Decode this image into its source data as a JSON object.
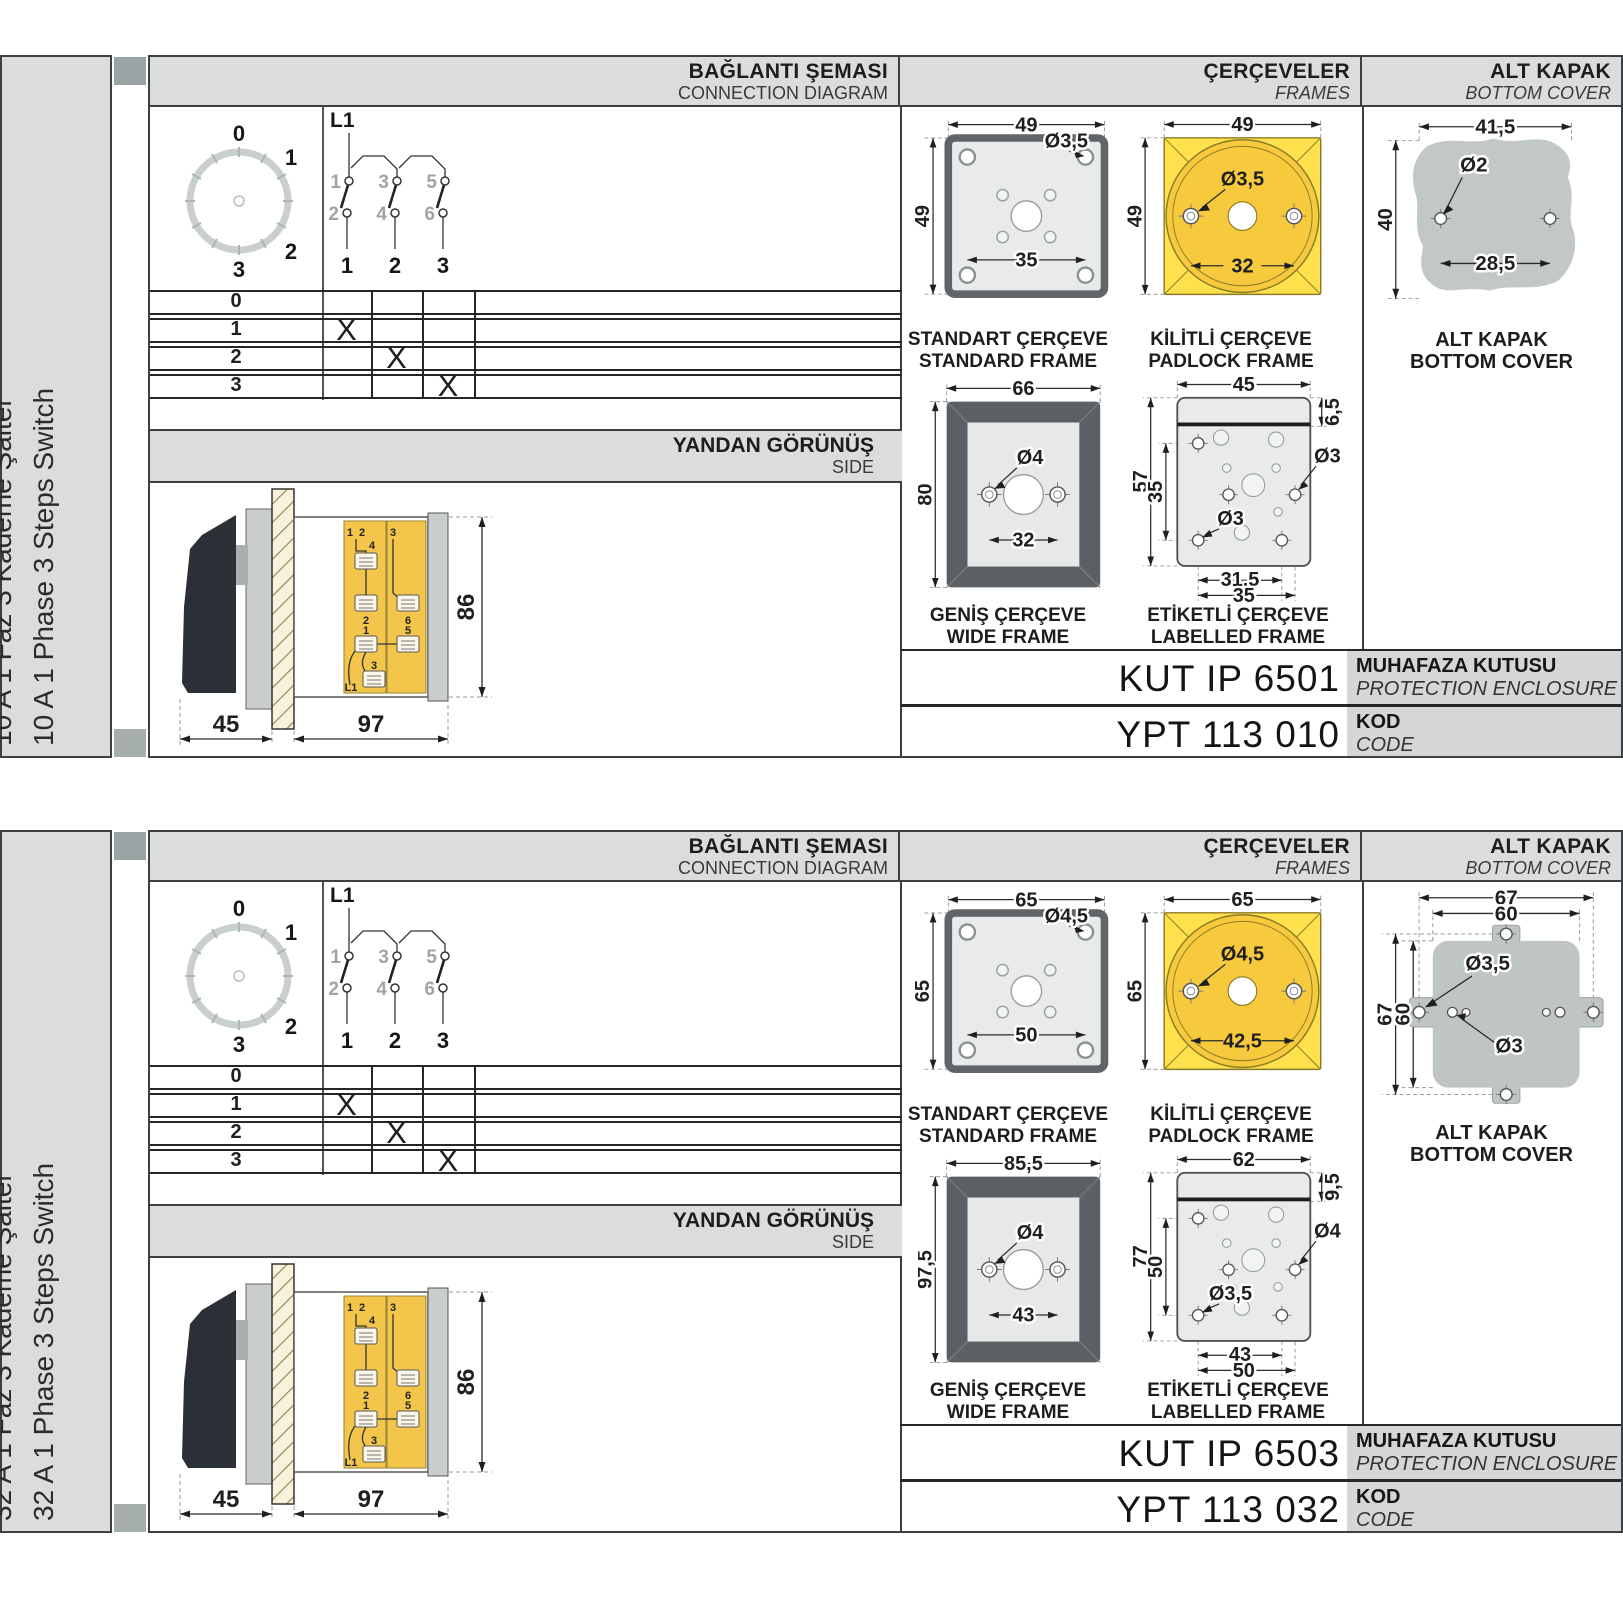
{
  "colors": {
    "accent_yellow": "#FFE14D",
    "golden": "#F7CA3E",
    "frame_dark": "#5B6065",
    "panel_gray": "#DBDCDC",
    "cover_gray": "#C2C7C7",
    "switch_body_yellow": "#F3C64B"
  },
  "sections": [
    {
      "sidebar": {
        "tr": "10 A 1 Faz 3 Kademe Şalter",
        "en": "10 A 1 Phase 3 Steps Switch"
      },
      "headers": {
        "connection": {
          "tr": "BAĞLANTI ŞEMASI",
          "en": "CONNECTION DIAGRAM"
        },
        "frames": {
          "tr": "ÇERÇEVELER",
          "en": "FRAMES"
        },
        "cover": {
          "tr": "ALT KAPAK",
          "en": "BOTTOM COVER"
        }
      },
      "dial": {
        "positions": [
          "0",
          "1",
          "2",
          "3"
        ]
      },
      "circuit": {
        "phase": "L1",
        "top_contacts": [
          "1",
          "3",
          "5"
        ],
        "bottom_contacts": [
          "2",
          "4",
          "6"
        ],
        "poles": [
          "1",
          "2",
          "3"
        ]
      },
      "truth_table": {
        "rows": [
          {
            "label": "0",
            "marks": [
              "",
              "",
              ""
            ]
          },
          {
            "label": "1",
            "marks": [
              "X",
              "",
              ""
            ]
          },
          {
            "label": "2",
            "marks": [
              "",
              "X",
              ""
            ]
          },
          {
            "label": "3",
            "marks": [
              "",
              "",
              "X"
            ]
          }
        ]
      },
      "side_view": {
        "tr": "YANDAN GÖRÜNÜŞ",
        "en": "SIDE",
        "dims": {
          "front": "45",
          "body": "97",
          "height": "86"
        },
        "labels": {
          "n1": "1",
          "n2": "2",
          "n4": "4",
          "b2": "2",
          "n3": "3",
          "b6": "6",
          "m1": "1",
          "m5": "5",
          "f3": "3",
          "phase": "L1"
        }
      },
      "frames": {
        "standard": {
          "tr": "STANDART ÇERÇEVE",
          "en": "STANDARD FRAME",
          "w": "49",
          "h": "49",
          "hole": "Ø3,5",
          "span": "35"
        },
        "padlock": {
          "tr": "KİLİTLİ ÇERÇEVE",
          "en": "PADLOCK FRAME",
          "w": "49",
          "h": "49",
          "hole": "Ø3,5",
          "span": "32"
        },
        "wide": {
          "tr": "GENİŞ ÇERÇEVE",
          "en": "WIDE FRAME",
          "w": "66",
          "h": "80",
          "hole": "Ø4",
          "span": "32"
        },
        "labelled": {
          "tr": "ETİKETLİ ÇERÇEVE",
          "en": "LABELLED FRAME",
          "w": "45",
          "strip": "6,5",
          "hole_right": "Ø3",
          "h": "57",
          "h_inner": "35",
          "hole_left": "Ø3",
          "span_inner": "31,5",
          "span_outer": "35"
        }
      },
      "cover": {
        "tr": "ALT KAPAK",
        "en": "BOTTOM COVER",
        "w": "41,5",
        "hole": "Ø2",
        "h": "40",
        "span": "28,5"
      },
      "enclosure": {
        "value": "KUT IP 6501",
        "tr": "MUHAFAZA KUTUSU",
        "en": "PROTECTION ENCLOSURE"
      },
      "code": {
        "value": "YPT 113 010",
        "tr": "KOD",
        "en": "CODE"
      }
    },
    {
      "sidebar": {
        "tr": "32 A 1 Faz 3 Kademe Şalter",
        "en": "32 A 1 Phase 3 Steps Switch"
      },
      "headers": {
        "connection": {
          "tr": "BAĞLANTI ŞEMASI",
          "en": "CONNECTION DIAGRAM"
        },
        "frames": {
          "tr": "ÇERÇEVELER",
          "en": "FRAMES"
        },
        "cover": {
          "tr": "ALT KAPAK",
          "en": "BOTTOM COVER"
        }
      },
      "dial": {
        "positions": [
          "0",
          "1",
          "2",
          "3"
        ]
      },
      "circuit": {
        "phase": "L1",
        "top_contacts": [
          "1",
          "3",
          "5"
        ],
        "bottom_contacts": [
          "2",
          "4",
          "6"
        ],
        "poles": [
          "1",
          "2",
          "3"
        ]
      },
      "truth_table": {
        "rows": [
          {
            "label": "0",
            "marks": [
              "",
              "",
              ""
            ]
          },
          {
            "label": "1",
            "marks": [
              "X",
              "",
              ""
            ]
          },
          {
            "label": "2",
            "marks": [
              "",
              "X",
              ""
            ]
          },
          {
            "label": "3",
            "marks": [
              "",
              "",
              "X"
            ]
          }
        ]
      },
      "side_view": {
        "tr": "YANDAN GÖRÜNÜŞ",
        "en": "SIDE",
        "dims": {
          "front": "45",
          "body": "97",
          "height": "86"
        },
        "labels": {
          "n1": "1",
          "n2": "2",
          "n4": "4",
          "b2": "2",
          "n3": "3",
          "b6": "6",
          "m1": "1",
          "m5": "5",
          "f3": "3",
          "phase": "L1"
        }
      },
      "frames": {
        "standard": {
          "tr": "STANDART ÇERÇEVE",
          "en": "STANDARD FRAME",
          "w": "65",
          "h": "65",
          "hole": "Ø4,5",
          "span": "50"
        },
        "padlock": {
          "tr": "KİLİTLİ ÇERÇEVE",
          "en": "PADLOCK FRAME",
          "w": "65",
          "h": "65",
          "hole": "Ø4,5",
          "span": "42,5"
        },
        "wide": {
          "tr": "GENİŞ ÇERÇEVE",
          "en": "WIDE FRAME",
          "w": "85,5",
          "h": "97,5",
          "hole": "Ø4",
          "span": "43"
        },
        "labelled": {
          "tr": "ETİKETLİ ÇERÇEVE",
          "en": "LABELLED FRAME",
          "w": "62",
          "strip": "9,5",
          "hole_right": "Ø4",
          "h": "77",
          "h_inner": "50",
          "hole_left": "Ø3,5",
          "span_inner": "43",
          "span_outer": "50"
        }
      },
      "cover": {
        "tr": "ALT KAPAK",
        "en": "BOTTOM COVER",
        "w_outer": "67",
        "w_inner": "60",
        "h_outer": "67",
        "h_inner": "60",
        "hole_big": "Ø3,5",
        "hole_small": "Ø3"
      },
      "enclosure": {
        "value": "KUT IP 6503",
        "tr": "MUHAFAZA KUTUSU",
        "en": "PROTECTION ENCLOSURE"
      },
      "code": {
        "value": "YPT 113 032",
        "tr": "KOD",
        "en": "CODE"
      }
    }
  ]
}
